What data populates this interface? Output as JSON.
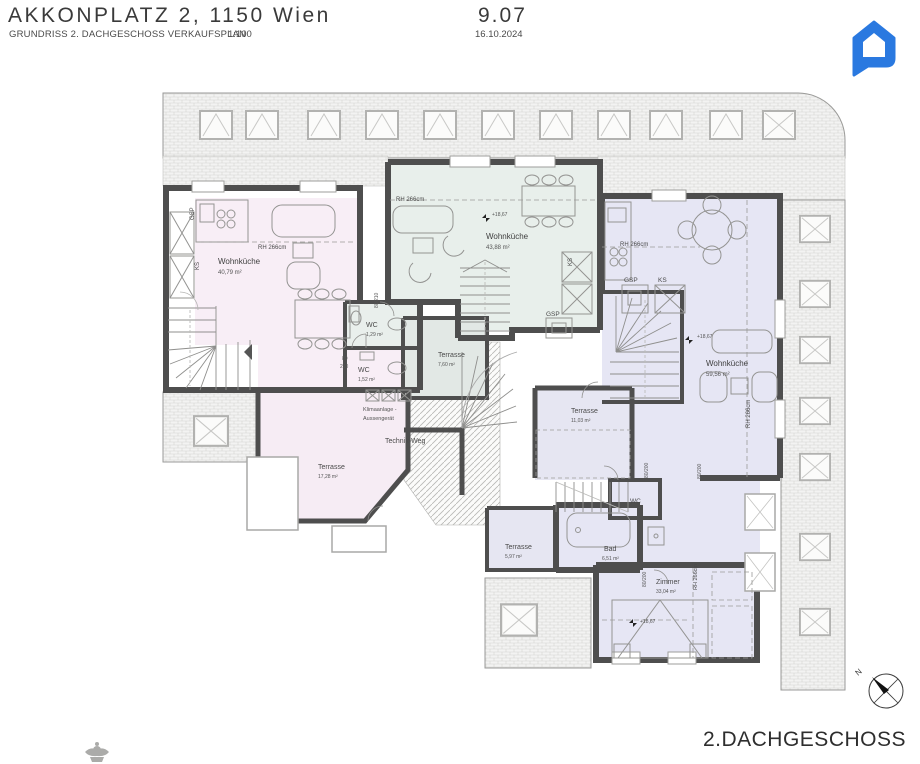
{
  "header": {
    "title": "AKKONPLATZ 2, 1150 Wien",
    "subtitle": "GRUNDRISS 2. DACHGESCHOSS VERKAUFSPLAN",
    "scale": "1:100",
    "sheet_number": "9.07",
    "date": "16.10.2024"
  },
  "footer": {
    "floor_label": "2.DACHGESCHOSS"
  },
  "compass": {
    "north_label": "N"
  },
  "logo": {
    "name": "house-chat-logo",
    "color": "#2a79e0"
  },
  "colors": {
    "unit_pink": "#f8eef6",
    "unit_green": "#e8efeb",
    "unit_lavender": "#e6e6f4",
    "terrace_green": "#e2e8e5",
    "terrace_lavender": "#e6e6f2",
    "wall": "#4e4e4e"
  },
  "rooms": [
    {
      "name": "Wohnküche",
      "area": "40,79 m²"
    },
    {
      "name": "Wohnküche",
      "area": "43,88 m²"
    },
    {
      "name": "Wohnküche",
      "area": "59,56 m²"
    },
    {
      "name": "WC",
      "area": "1,29 m²"
    },
    {
      "name": "WC",
      "area": "1,52 m²"
    },
    {
      "name": "Bad",
      "area": "6,51 m²"
    },
    {
      "name": "Zimmer",
      "area": "33,04 m²"
    },
    {
      "name": "Terrasse",
      "area": "7,60 m²"
    },
    {
      "name": "Terrasse",
      "area": "17,28 m²"
    },
    {
      "name": "Terrasse",
      "area": "11,03 m²"
    },
    {
      "name": "Terrasse",
      "area": "5,97 m²"
    },
    {
      "name": "WC",
      "area": ""
    }
  ],
  "annotations": {
    "rh": "RH 266cm",
    "level": "+18,67",
    "gsp": "GSP",
    "ks": "KS",
    "door_80": "80",
    "door_210": "210",
    "door_80_210": "80/210",
    "door_80_200": "80/200",
    "klima_line1": "Klimaanlage -",
    "klima_line2": "Aussengerät",
    "technik_weg": "Technik-Weg"
  }
}
